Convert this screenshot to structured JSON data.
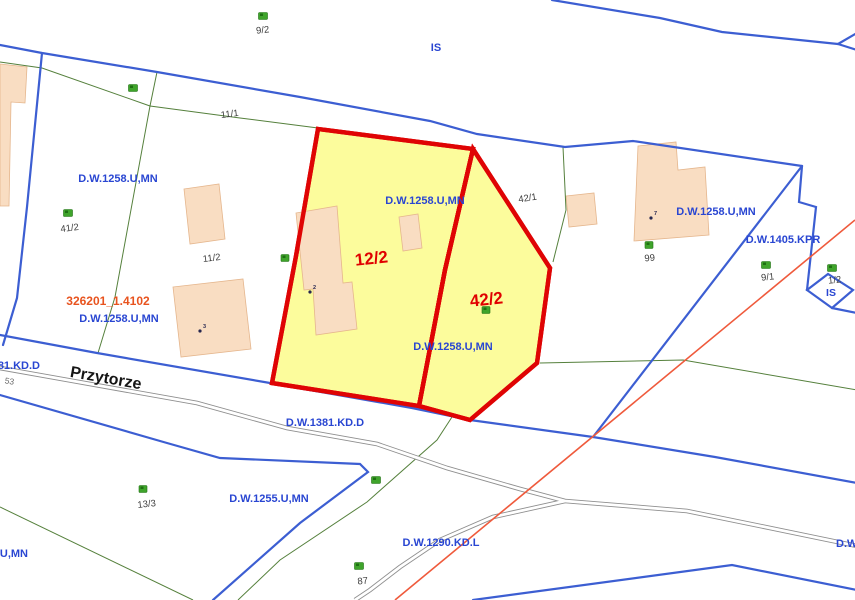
{
  "app": {
    "type": "cadastral-map-view"
  },
  "colors": {
    "highlight_parcel_fill": "#FCFC9C",
    "highlight_parcel_border": "#DF0404",
    "boundary_blue": "#3C5ED2",
    "zone_label_blue": "#2946D2",
    "parcel_line_green": "#55803C",
    "road_gray": "#8F8F8F",
    "utility_line_orange": "#EF5A3C",
    "building_fill": "#F9DDC2",
    "highlight_label_red": "#E00000",
    "ref_label_orange": "#E8531E",
    "tree_icon_green": "#3FA42B"
  },
  "zones": {
    "dw1258": "D.W.1258.U,MN",
    "dw1405": "D.W.1405.KPR",
    "dw1381": "D.W.1381.KD.D",
    "dw1255": "D.W.1255.U,MN",
    "dw1290": "D.W.1290.KD.L",
    "dw_partial": "D.W.",
    "is": "IS"
  },
  "highlighted": {
    "parcel_a": "12/2",
    "parcel_b": "42/2"
  },
  "parcel_numbers": {
    "p9_2": "9/2",
    "p11_1": "11/1",
    "p41_2": "41/2",
    "p11_2": "11/2",
    "p42_1": "42/1",
    "p99": "99",
    "p9_1": "9/1",
    "p1_2": "1/2",
    "p53": "53",
    "p13_3": "13/3",
    "p87": "87"
  },
  "address_points": {
    "n2": "2",
    "n3": "3",
    "n7": "7"
  },
  "street": {
    "name": "Przytorze"
  },
  "ref": {
    "sheet_id": "326201_1.4102"
  }
}
